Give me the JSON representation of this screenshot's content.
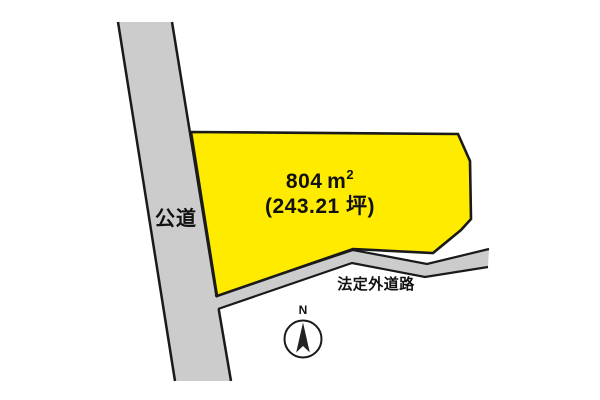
{
  "parcel": {
    "area_value": "804",
    "area_unit": "m",
    "area_unit_exponent": "2",
    "area_tsubo": "(243.21 坪)"
  },
  "roads": {
    "public_road_label": "公道",
    "legal_outside_road_label": "法定外道路"
  },
  "compass": {
    "north_label": "N"
  },
  "colors": {
    "parcel_fill": "#ffeb00",
    "road_fill": "#cccccc",
    "outline": "#1a1a1a",
    "background": "#ffffff"
  }
}
